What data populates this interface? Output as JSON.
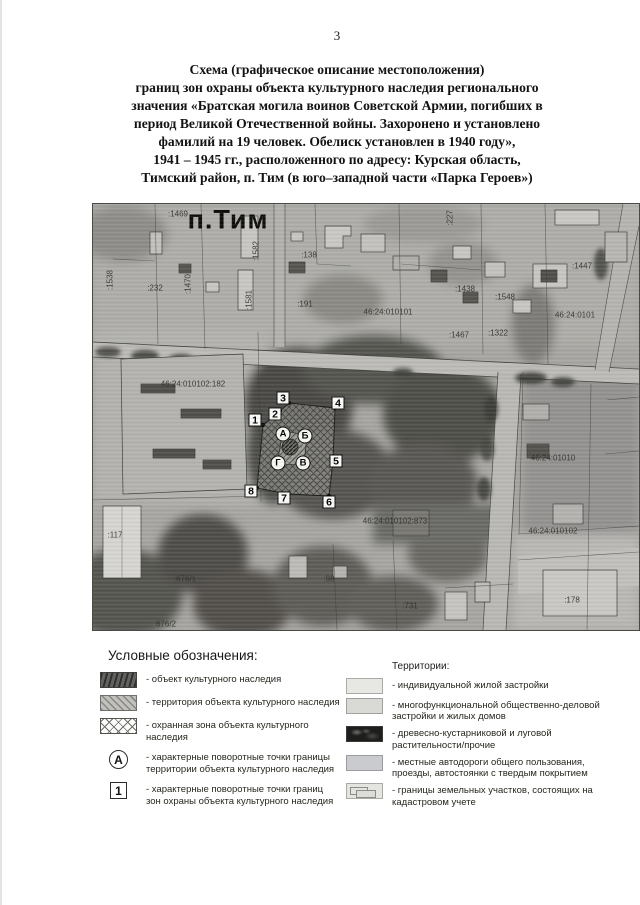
{
  "page": {
    "number": "3"
  },
  "title": {
    "lines": [
      "Схема (графическое описание местоположения)",
      "границ зон охраны объекта культурного наследия регионального",
      "значения «Братская могила воинов Советской Армии, погибших в",
      "период Великой Отечественной войны. Захоронено и установлено",
      "фамилий на 19 человек. Обелиск установлен в 1940 году»,",
      "1941 – 1945 гг., расположенного по адресу: Курская область,",
      "Тимский район, п. Тим (в юго–западной части «Парка Героев»)"
    ]
  },
  "map": {
    "settlement_label": "п.Тим",
    "settlement_pos": {
      "x": 135,
      "y": 16
    },
    "cadastral_labels": [
      {
        "text": ":1469",
        "x": 85,
        "y": 10,
        "rot": false
      },
      {
        "text": ":227",
        "x": 357,
        "y": 14,
        "rot": true
      },
      {
        "text": ":1538",
        "x": 17,
        "y": 76,
        "rot": true
      },
      {
        "text": ":232",
        "x": 62,
        "y": 84,
        "rot": false
      },
      {
        "text": ":1470",
        "x": 95,
        "y": 80,
        "rot": true
      },
      {
        "text": ":1582",
        "x": 163,
        "y": 47,
        "rot": true
      },
      {
        "text": ":1581",
        "x": 156,
        "y": 96,
        "rot": true
      },
      {
        "text": ":138",
        "x": 216,
        "y": 51,
        "rot": false
      },
      {
        "text": ":191",
        "x": 212,
        "y": 100,
        "rot": false
      },
      {
        "text": "46:24:010101",
        "x": 295,
        "y": 108,
        "rot": false
      },
      {
        "text": ":1438",
        "x": 372,
        "y": 85,
        "rot": false
      },
      {
        "text": ":1548",
        "x": 412,
        "y": 93,
        "rot": false
      },
      {
        "text": ":1447",
        "x": 489,
        "y": 62,
        "rot": false
      },
      {
        "text": "46:24:0101",
        "x": 482,
        "y": 111,
        "rot": false
      },
      {
        "text": ":1467",
        "x": 366,
        "y": 131,
        "rot": false
      },
      {
        "text": ":1322",
        "x": 405,
        "y": 129,
        "rot": false
      },
      {
        "text": "46:24:010102:182",
        "x": 100,
        "y": 180,
        "rot": false
      },
      {
        "text": "46:24:01010",
        "x": 460,
        "y": 254,
        "rot": false
      },
      {
        "text": "46:24:010102:873",
        "x": 302,
        "y": 317,
        "rot": false
      },
      {
        "text": ":117",
        "x": 22,
        "y": 331,
        "rot": false
      },
      {
        "text": ":676/1",
        "x": 92,
        "y": 375,
        "rot": false
      },
      {
        "text": ":98",
        "x": 236,
        "y": 375,
        "rot": false
      },
      {
        "text": ":731",
        "x": 317,
        "y": 402,
        "rot": false
      },
      {
        "text": "676/2",
        "x": 73,
        "y": 420,
        "rot": false
      },
      {
        "text": "46:24:010102",
        "x": 460,
        "y": 327,
        "rot": false
      },
      {
        "text": ":178",
        "x": 479,
        "y": 396,
        "rot": false
      }
    ],
    "zone_points": [
      {
        "label": "1",
        "x": 162,
        "y": 216
      },
      {
        "label": "2",
        "x": 182,
        "y": 210
      },
      {
        "label": "3",
        "x": 190,
        "y": 194
      },
      {
        "label": "4",
        "x": 245,
        "y": 199
      },
      {
        "label": "5",
        "x": 243,
        "y": 257
      },
      {
        "label": "6",
        "x": 236,
        "y": 298
      },
      {
        "label": "7",
        "x": 191,
        "y": 294
      },
      {
        "label": "8",
        "x": 158,
        "y": 287
      }
    ],
    "territory_points": [
      {
        "label": "А",
        "x": 190,
        "y": 230
      },
      {
        "label": "Б",
        "x": 212,
        "y": 232
      },
      {
        "label": "В",
        "x": 210,
        "y": 259
      },
      {
        "label": "Г",
        "x": 185,
        "y": 259
      }
    ],
    "zone_vertices": [
      {
        "x": 170,
        "y": 221
      },
      {
        "x": 187,
        "y": 207
      },
      {
        "x": 196,
        "y": 199
      },
      {
        "x": 242,
        "y": 204
      },
      {
        "x": 240,
        "y": 257
      },
      {
        "x": 236,
        "y": 292
      },
      {
        "x": 194,
        "y": 290
      },
      {
        "x": 164,
        "y": 284
      }
    ],
    "territory_vertices": [
      {
        "x": 190,
        "y": 227
      },
      {
        "x": 214,
        "y": 231
      },
      {
        "x": 211,
        "y": 261
      },
      {
        "x": 184,
        "y": 260
      }
    ],
    "object_center": {
      "x": 197,
      "y": 243,
      "r": 8
    }
  },
  "legend": {
    "heading": "Условные обозначения:",
    "right_heading": "Территории:",
    "left_items": [
      {
        "swatch": "object",
        "label": "- объект культурного наследия"
      },
      {
        "swatch": "territory",
        "label": "- территория объекта культурного наследия"
      },
      {
        "swatch": "zone",
        "label": "- охранная зона объекта культурного наследия"
      },
      {
        "swatch": "circle",
        "marker": "А",
        "label": "- характерные поворотные точки границы\nтерритории объекта культурного наследия"
      },
      {
        "swatch": "square",
        "marker": "1",
        "label": "- характерные поворотные точки границ\nзон охраны объекта культурного наследия"
      }
    ],
    "right_items": [
      {
        "swatch": "residential",
        "label": "- индивидуальной жилой застройки"
      },
      {
        "swatch": "multifunc",
        "label": "- многофункциональной общественно-деловой\nзастройки и жилых домов"
      },
      {
        "swatch": "vegetation",
        "label": "- древесно-кустарниковой и луговой\nрастительности/прочие"
      },
      {
        "swatch": "roads",
        "label": "- местные автодороги общего пользования,\nпроезды, автостоянки с твердым покрытием"
      },
      {
        "swatch": "parcels",
        "label": "- границы земельных участков, состоящих на\nкадастровом учете"
      }
    ]
  }
}
